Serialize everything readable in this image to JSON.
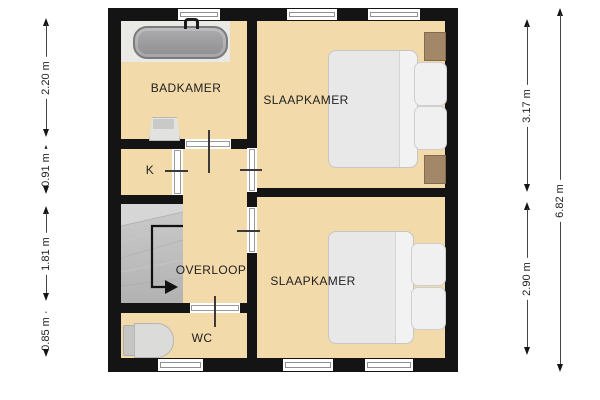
{
  "rooms": {
    "badkamer": "BADKAMER",
    "slaapkamer_top": "SLAAPKAMER",
    "kast": "K",
    "overloop": "OVERLOOP",
    "wc": "WC",
    "slaapkamer_bottom": "SLAAPKAMER"
  },
  "dimensions": {
    "left": [
      {
        "label": "2.20 m"
      },
      {
        "label": "0.91 m"
      },
      {
        "label": "1.81 m"
      },
      {
        "label": "0.85 m"
      }
    ],
    "right": [
      {
        "label": "3.17 m"
      },
      {
        "label": "2.90 m"
      },
      {
        "label": "6.82 m"
      }
    ]
  },
  "fixtures": {
    "bathtub": "bathtub",
    "sink": "washbasin",
    "toilet": "toilet",
    "stairs": "staircase-down-arrow",
    "bed_top": "double-bed-with-nightstands",
    "bed_bottom": "double-bed"
  },
  "colors": {
    "floor": "#F2DAAB",
    "wall": "#141414",
    "stairs_gray": "#B9B9B9",
    "fixture_gray": "#D9D9D7",
    "bedding": "#E9E9E9",
    "nightstand_brown": "#A28768",
    "background": "#FFFFFF",
    "text": "#222222"
  }
}
